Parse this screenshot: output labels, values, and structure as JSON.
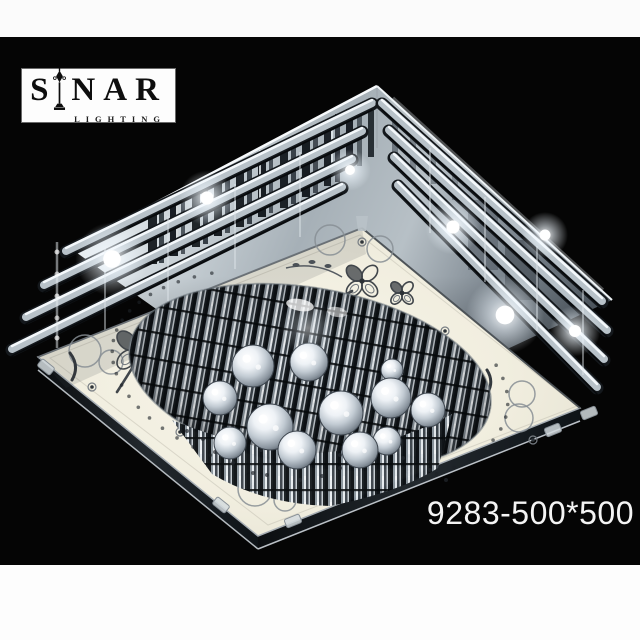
{
  "frame": {
    "top_band_color": "#fbfbfb",
    "bottom_band_color": "#fdfdfd",
    "photo_background": "#050505"
  },
  "logo": {
    "brand_left": "S",
    "brand_right": "NAR",
    "subtitle": "LIGHTING",
    "icon": "street-lamp-icon",
    "box_color": "#fdfdfd",
    "text_color": "#0e0e0e"
  },
  "product_code": "9283-500*500",
  "palette": {
    "chrome_light": "#eff3f5",
    "chrome_mid": "#a6b0b7",
    "chrome_dark": "#4d565e",
    "panel_cream": "#f1eedf",
    "panel_edge_dark": "#0b0e11",
    "decor_gray": "#41464b"
  },
  "lamp": {
    "glows": [
      [
        112,
        259,
        16
      ],
      [
        207,
        198,
        12
      ],
      [
        350,
        170,
        9
      ],
      [
        453,
        227,
        12
      ],
      [
        505,
        315,
        17
      ],
      [
        545,
        235,
        10
      ],
      [
        575,
        331,
        11
      ]
    ],
    "balls": [
      [
        253,
        366,
        21
      ],
      [
        309,
        362,
        19
      ],
      [
        392,
        370,
        11
      ],
      [
        220,
        398,
        17
      ],
      [
        270,
        427,
        23
      ],
      [
        341,
        413,
        22
      ],
      [
        391,
        398,
        20
      ],
      [
        428,
        410,
        17
      ],
      [
        230,
        443,
        16
      ],
      [
        297,
        450,
        19
      ],
      [
        360,
        450,
        18
      ],
      [
        387,
        441,
        14
      ]
    ],
    "streaks": [
      [
        148,
        206,
        9,
        58,
        "#14191d",
        0.95
      ],
      [
        159,
        201,
        5,
        62,
        "#2e363d",
        0.9
      ],
      [
        170,
        196,
        8,
        60,
        "#0f141a",
        0.95
      ],
      [
        181,
        190,
        4,
        64,
        "#3a424a",
        0.85
      ],
      [
        192,
        185,
        8,
        62,
        "#161b20",
        0.95
      ],
      [
        203,
        180,
        5,
        64,
        "#272f36",
        0.9
      ],
      [
        214,
        174,
        8,
        62,
        "#0e1317",
        0.95
      ],
      [
        225,
        169,
        5,
        64,
        "#333b43",
        0.85
      ],
      [
        236,
        163,
        8,
        64,
        "#151a1f",
        0.95
      ],
      [
        247,
        158,
        5,
        66,
        "#2a323a",
        0.9
      ],
      [
        258,
        153,
        8,
        64,
        "#10151a",
        0.95
      ],
      [
        269,
        147,
        4,
        66,
        "#363e46",
        0.85
      ],
      [
        280,
        142,
        8,
        66,
        "#13181d",
        0.95
      ],
      [
        291,
        136,
        5,
        68,
        "#2c343c",
        0.9
      ],
      [
        302,
        131,
        8,
        66,
        "#0f1419",
        0.95
      ],
      [
        313,
        125,
        5,
        68,
        "#323a42",
        0.85
      ],
      [
        324,
        120,
        7,
        66,
        "#161b21",
        0.95
      ],
      [
        335,
        114,
        5,
        68,
        "#292f37",
        0.9
      ],
      [
        346,
        109,
        7,
        64,
        "#12171d",
        0.95
      ],
      [
        357,
        104,
        5,
        62,
        "#3b434b",
        0.8
      ],
      [
        368,
        99,
        6,
        58,
        "#1a2026",
        0.9
      ],
      [
        176,
        188,
        2,
        58,
        "#f6fafc",
        0.85
      ],
      [
        259,
        150,
        2,
        60,
        "#f0f5f8",
        0.8
      ],
      [
        331,
        117,
        2,
        58,
        "#eaf0f4",
        0.75
      ],
      [
        392,
        110,
        6,
        46,
        "#4c555d",
        0.65
      ],
      [
        410,
        126,
        6,
        44,
        "#575f68",
        0.6
      ],
      [
        430,
        144,
        6,
        40,
        "#4e575f",
        0.55
      ],
      [
        452,
        164,
        6,
        36,
        "#59626a",
        0.5
      ],
      [
        468,
        200,
        30,
        70,
        "#39424a",
        0.4
      ],
      [
        505,
        240,
        34,
        60,
        "#2e353c",
        0.45
      ]
    ],
    "tiers_left": [
      [
        372,
        104,
        66,
        252
      ],
      [
        362,
        132,
        44,
        286
      ],
      [
        352,
        160,
        26,
        318
      ],
      [
        342,
        188,
        12,
        350
      ]
    ],
    "tiers_right": [
      [
        382,
        104,
        602,
        302
      ],
      [
        389,
        131,
        607,
        331
      ],
      [
        394,
        158,
        604,
        360
      ],
      [
        398,
        186,
        597,
        388
      ]
    ],
    "posts": [
      [
        300,
        152
      ],
      [
        235,
        184
      ],
      [
        168,
        216
      ],
      [
        105,
        248
      ],
      [
        430,
        148
      ],
      [
        485,
        197
      ],
      [
        537,
        246
      ],
      [
        583,
        290
      ]
    ],
    "clovers": [
      {
        "x": 136,
        "y": 350,
        "s": 17,
        "stem": "M134,365 Q126,378 117,392"
      },
      {
        "x": 362,
        "y": 281,
        "s": 14,
        "stem": "M352,291 Q344,296 337,298"
      },
      {
        "x": 402,
        "y": 293,
        "s": 10
      },
      {
        "x": 466,
        "y": 408,
        "s": 15,
        "stem": "M459,421 Q452,431 444,439"
      }
    ],
    "vines": [
      "M286,268 Q316,261 342,277"
    ],
    "vine_leaves": [
      [
        296,
        265
      ],
      [
        312,
        262
      ],
      [
        328,
        266
      ]
    ],
    "curls": [
      "M70,353 Q80,366 72,380",
      "M487,370 Q494,381 488,392"
    ],
    "etched_circles": [
      [
        330,
        240,
        15
      ],
      [
        380,
        249,
        13
      ],
      [
        85,
        351,
        16
      ],
      [
        111,
        362,
        12
      ],
      [
        522,
        394,
        13
      ],
      [
        519,
        418,
        14
      ],
      [
        255,
        489,
        17
      ],
      [
        285,
        500,
        11
      ]
    ],
    "gems": [
      [
        210,
        302,
        4
      ],
      [
        92,
        387,
        4
      ],
      [
        445,
        331,
        4
      ],
      [
        533,
        440,
        4
      ],
      [
        180,
        432,
        4
      ],
      [
        253,
        486,
        3
      ],
      [
        408,
        470,
        3
      ],
      [
        362,
        242,
        4
      ]
    ],
    "clips": [
      [
        221,
        505,
        39
      ],
      [
        293,
        521,
        -22
      ],
      [
        553,
        430,
        -22
      ],
      [
        589,
        413,
        -22
      ],
      [
        46,
        367,
        39
      ]
    ],
    "beads": [
      [
        215,
        452
      ],
      [
        240,
        453
      ],
      [
        261,
        450
      ],
      [
        340,
        455
      ],
      [
        373,
        458
      ],
      [
        385,
        450
      ],
      [
        403,
        458
      ],
      [
        233,
        463
      ],
      [
        253,
        473
      ],
      [
        267,
        475
      ],
      [
        340,
        468
      ],
      [
        357,
        465
      ],
      [
        300,
        480
      ],
      [
        322,
        476
      ],
      [
        187,
        431
      ],
      [
        203,
        439
      ],
      [
        430,
        470
      ],
      [
        446,
        480
      ]
    ],
    "dot_arcs": [
      {
        "from": 115,
        "to": 240,
        "step": 6
      },
      {
        "from": -25,
        "to": 55,
        "step": 7
      }
    ],
    "recess": {
      "cx": 310,
      "cy": 377,
      "rx": 183,
      "ry": 89,
      "rot": 10
    }
  }
}
